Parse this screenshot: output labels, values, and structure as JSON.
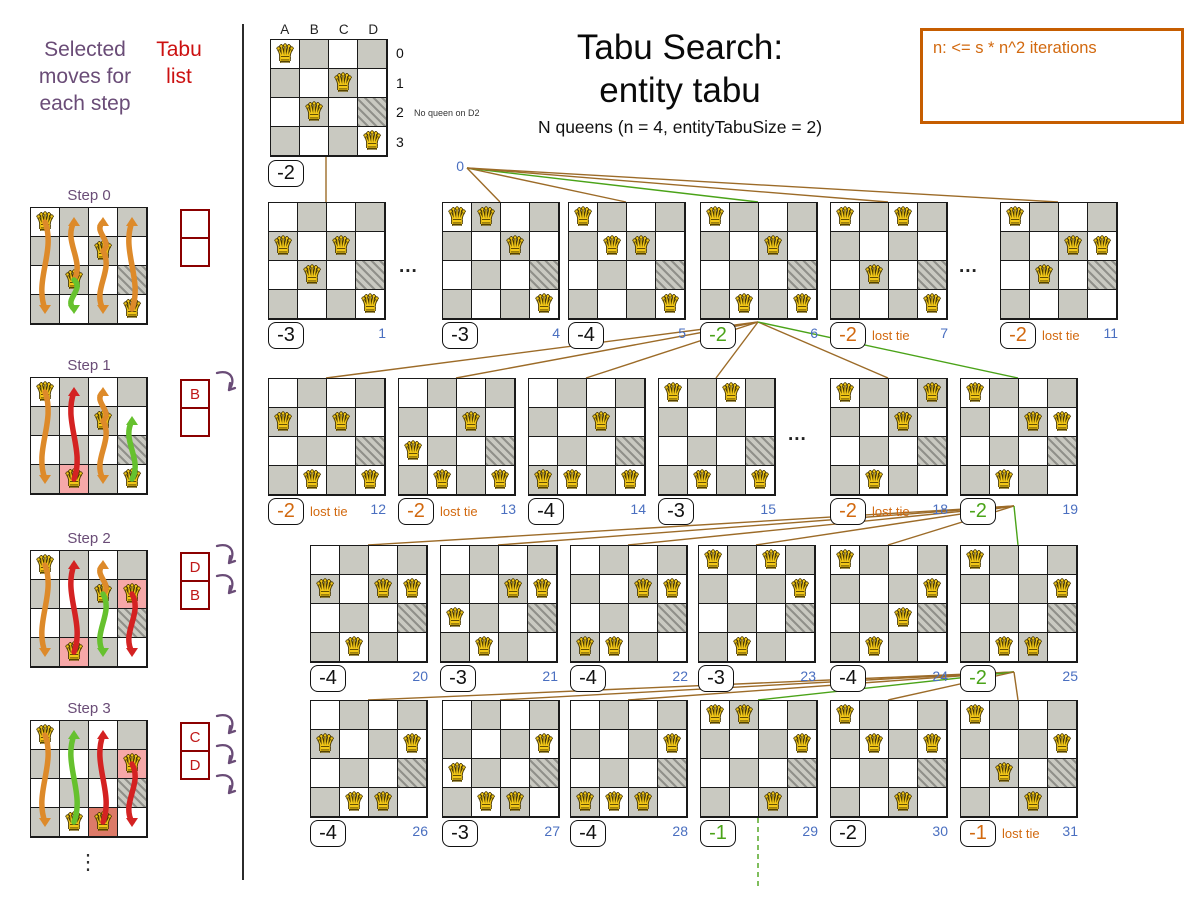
{
  "page": {
    "title1": "Tabu Search:",
    "title2": "entity tabu",
    "subtitle": "N queens (n = 4, entityTabuSize = 2)",
    "note": "n: <= s * n^2 iterations",
    "legend_moves": "Selected moves for each step",
    "legend_tabu": "Tabu list",
    "lost_tie": "lost tie",
    "ellipsis": "⋮",
    "dots": "..."
  },
  "colors": {
    "purple": "#6a4c77",
    "red_text": "#cc1111",
    "tabu_border": "#8b0000",
    "tabu_letter": "#c01818",
    "orange": "#d2690f",
    "note_border": "#c65d00",
    "blue": "#4a6fc0",
    "green": "#4aa318",
    "brown": "#9c6b28",
    "black": "#1a1a1a",
    "board_dark": "#c9c9c1",
    "hl_pink": "#f6a8a8",
    "hl_red": "#dc7a68",
    "queen_gold": "#f3c818",
    "arrow_orange": "#dd8a2a",
    "arrow_red": "#d42222",
    "arrow_green": "#66c12e"
  },
  "hatched_cell": "D2",
  "root": {
    "col_labels": [
      "A",
      "B",
      "C",
      "D"
    ],
    "row_labels": [
      "0",
      "1",
      "2",
      "3"
    ],
    "annotation": "No queen on D2",
    "queens": [
      "A0",
      "C1",
      "B2",
      "D3"
    ],
    "score": "-2",
    "score_color": "black",
    "index": "0"
  },
  "steps": [
    {
      "label": "Step 0",
      "queens": [
        "A0",
        "C1",
        "B2",
        "D3"
      ],
      "highlights": [],
      "tabu": [
        "",
        ""
      ],
      "tabu_arrows": 0,
      "arrows": [
        {
          "col": "A",
          "from": 0,
          "to": 3,
          "color": "orange"
        },
        {
          "col": "B",
          "from": 2,
          "to": 0,
          "color": "orange"
        },
        {
          "col": "B",
          "from": 2,
          "to": 3,
          "color": "green"
        },
        {
          "col": "C",
          "from": 1,
          "to": 0,
          "color": "orange"
        },
        {
          "col": "C",
          "from": 1,
          "to": 3,
          "color": "orange"
        },
        {
          "col": "D",
          "from": 3,
          "to": 0,
          "color": "orange"
        }
      ]
    },
    {
      "label": "Step 1",
      "queens": [
        "A0",
        "C1",
        "B3",
        "D3"
      ],
      "highlights": [
        {
          "cell": "B3",
          "type": "pink"
        }
      ],
      "tabu": [
        "B",
        ""
      ],
      "tabu_arrows": 1,
      "arrows": [
        {
          "col": "A",
          "from": 0,
          "to": 3,
          "color": "orange"
        },
        {
          "col": "B",
          "from": 3,
          "to": 0,
          "color": "red"
        },
        {
          "col": "C",
          "from": 1,
          "to": 0,
          "color": "orange"
        },
        {
          "col": "C",
          "from": 1,
          "to": 3,
          "color": "orange"
        },
        {
          "col": "D",
          "from": 3,
          "to": 1,
          "color": "green"
        }
      ]
    },
    {
      "label": "Step 2",
      "queens": [
        "A0",
        "C1",
        "D1",
        "B3"
      ],
      "highlights": [
        {
          "cell": "D1",
          "type": "pink"
        },
        {
          "cell": "B3",
          "type": "pink"
        }
      ],
      "tabu": [
        "D",
        "B"
      ],
      "tabu_arrows": 2,
      "arrows": [
        {
          "col": "A",
          "from": 0,
          "to": 3,
          "color": "orange"
        },
        {
          "col": "B",
          "from": 3,
          "to": 0,
          "color": "red"
        },
        {
          "col": "C",
          "from": 1,
          "to": 0,
          "color": "orange"
        },
        {
          "col": "C",
          "from": 1,
          "to": 3,
          "color": "green"
        },
        {
          "col": "D",
          "from": 1,
          "to": 3,
          "color": "red"
        }
      ]
    },
    {
      "label": "Step 3",
      "queens": [
        "A0",
        "D1",
        "B3",
        "C3"
      ],
      "highlights": [
        {
          "cell": "D1",
          "type": "pink"
        },
        {
          "cell": "C3",
          "type": "red"
        }
      ],
      "tabu": [
        "C",
        "D"
      ],
      "tabu_arrows": 3,
      "arrows": [
        {
          "col": "A",
          "from": 0,
          "to": 3,
          "color": "orange"
        },
        {
          "col": "B",
          "from": 3,
          "to": 0,
          "color": "green"
        },
        {
          "col": "C",
          "from": 3,
          "to": 0,
          "color": "red"
        },
        {
          "col": "D",
          "from": 1,
          "to": 3,
          "color": "red"
        }
      ]
    }
  ],
  "rows": [
    {
      "y": 202,
      "fan": [
        467,
        168
      ],
      "boards": [
        {
          "x": 268,
          "queens": [
            "A1",
            "C1",
            "B2",
            "D3"
          ],
          "score": "-3",
          "score_color": "black",
          "index": "1",
          "vertical_edge": true
        },
        {
          "x": 442,
          "queens": [
            "A0",
            "B0",
            "C1",
            "D3"
          ],
          "score": "-3",
          "score_color": "black",
          "index": "4"
        },
        {
          "x": 568,
          "queens": [
            "A0",
            "B1",
            "C1",
            "D3"
          ],
          "score": "-4",
          "score_color": "black",
          "index": "5"
        },
        {
          "x": 700,
          "queens": [
            "A0",
            "C1",
            "B3",
            "D3"
          ],
          "score": "-2",
          "score_color": "green",
          "index": "6",
          "selected": true
        },
        {
          "x": 830,
          "queens": [
            "A0",
            "C0",
            "B2",
            "D3"
          ],
          "score": "-2",
          "score_color": "orange",
          "index": "7",
          "lost_tie": true
        },
        {
          "x": 1000,
          "queens": [
            "A0",
            "C1",
            "D1",
            "B2"
          ],
          "score": "-2",
          "score_color": "orange",
          "index": "11",
          "lost_tie": true
        }
      ],
      "dots": [
        {
          "x": 399,
          "y": 256
        },
        {
          "x": 959,
          "y": 256
        }
      ]
    },
    {
      "y": 378,
      "fan": [
        758,
        322
      ],
      "boards": [
        {
          "x": 268,
          "queens": [
            "A1",
            "C1",
            "B3",
            "D3"
          ],
          "score": "-2",
          "score_color": "orange",
          "index": "12",
          "lost_tie": true
        },
        {
          "x": 398,
          "queens": [
            "C1",
            "A2",
            "B3",
            "D3"
          ],
          "score": "-2",
          "score_color": "orange",
          "index": "13",
          "lost_tie": true
        },
        {
          "x": 528,
          "queens": [
            "C1",
            "A3",
            "B3",
            "D3"
          ],
          "score": "-4",
          "score_color": "black",
          "index": "14"
        },
        {
          "x": 658,
          "queens": [
            "A0",
            "C0",
            "B3",
            "D3"
          ],
          "score": "-3",
          "score_color": "black",
          "index": "15"
        },
        {
          "x": 830,
          "queens": [
            "A0",
            "D0",
            "C1",
            "B3"
          ],
          "score": "-2",
          "score_color": "orange",
          "index": "18",
          "lost_tie": true
        },
        {
          "x": 960,
          "queens": [
            "A0",
            "C1",
            "D1",
            "B3"
          ],
          "score": "-2",
          "score_color": "green",
          "index": "19",
          "selected": true
        }
      ],
      "dots": [
        {
          "x": 788,
          "y": 424
        }
      ]
    },
    {
      "y": 545,
      "fan": [
        1014,
        506
      ],
      "boards": [
        {
          "x": 310,
          "queens": [
            "A1",
            "C1",
            "D1",
            "B3"
          ],
          "score": "-4",
          "score_color": "black",
          "index": "20"
        },
        {
          "x": 440,
          "queens": [
            "C1",
            "D1",
            "A2",
            "B3"
          ],
          "score": "-3",
          "score_color": "black",
          "index": "21"
        },
        {
          "x": 570,
          "queens": [
            "C1",
            "D1",
            "A3",
            "B3"
          ],
          "score": "-4",
          "score_color": "black",
          "index": "22"
        },
        {
          "x": 698,
          "queens": [
            "A0",
            "C0",
            "D1",
            "B3"
          ],
          "score": "-3",
          "score_color": "black",
          "index": "23"
        },
        {
          "x": 830,
          "queens": [
            "A0",
            "D1",
            "C2",
            "B3"
          ],
          "score": "-4",
          "score_color": "black",
          "index": "24"
        },
        {
          "x": 960,
          "queens": [
            "A0",
            "D1",
            "B3",
            "C3"
          ],
          "score": "-2",
          "score_color": "green",
          "index": "25",
          "selected": true
        }
      ],
      "dots": []
    },
    {
      "y": 700,
      "fan": [
        1014,
        672
      ],
      "boards": [
        {
          "x": 310,
          "queens": [
            "A1",
            "D1",
            "B3",
            "C3"
          ],
          "score": "-4",
          "score_color": "black",
          "index": "26"
        },
        {
          "x": 442,
          "queens": [
            "D1",
            "A2",
            "B3",
            "C3"
          ],
          "score": "-3",
          "score_color": "black",
          "index": "27"
        },
        {
          "x": 570,
          "queens": [
            "D1",
            "A3",
            "B3",
            "C3"
          ],
          "score": "-4",
          "score_color": "black",
          "index": "28"
        },
        {
          "x": 700,
          "queens": [
            "A0",
            "B0",
            "D1",
            "C3"
          ],
          "score": "-1",
          "score_color": "green",
          "index": "29",
          "selected": true,
          "dashed_below": true
        },
        {
          "x": 830,
          "queens": [
            "A0",
            "B1",
            "D1",
            "C3"
          ],
          "score": "-2",
          "score_color": "black",
          "index": "30"
        },
        {
          "x": 960,
          "queens": [
            "A0",
            "D1",
            "B2",
            "C3"
          ],
          "score": "-1",
          "score_color": "orange",
          "index": "31",
          "lost_tie": true
        }
      ],
      "dots": []
    }
  ]
}
